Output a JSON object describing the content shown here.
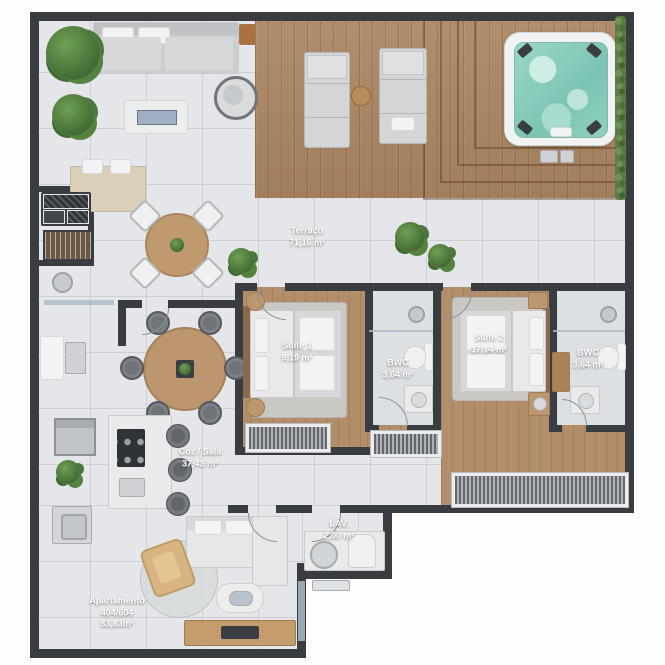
{
  "rooms": {
    "terraco": {
      "name": "Terraço",
      "area": "71,16 m²"
    },
    "suite1": {
      "name": "Suíte 1",
      "area": "9,19 m²"
    },
    "bwc1": {
      "name": "BWC",
      "area": "3,64 m²"
    },
    "suite2": {
      "name": "Suíte 2",
      "area": "17,14 m²"
    },
    "bwc2": {
      "name": "BWC",
      "area": "3,64 m²"
    },
    "coz_sala": {
      "name": "Coz / Sala",
      "area": "37,43 m²"
    },
    "lav": {
      "name": "LAV.",
      "area": "2,00 m²"
    },
    "apartamento": {
      "name": "Apartamento",
      "unit": "404/604",
      "area": "83,83m²"
    }
  },
  "palette": {
    "wall": "#393c41",
    "tile_floor": "#e4e6e9",
    "deck_wood": "#ac8663",
    "room_wood": "#b28e6a",
    "rug": "#cac8c5",
    "jacuzzi_water": "#8ed1c3",
    "plant": "#4d7a3c",
    "furniture_light": "#e9eaec",
    "furniture_wood": "#bb966e",
    "label_text": "#ffffff"
  }
}
